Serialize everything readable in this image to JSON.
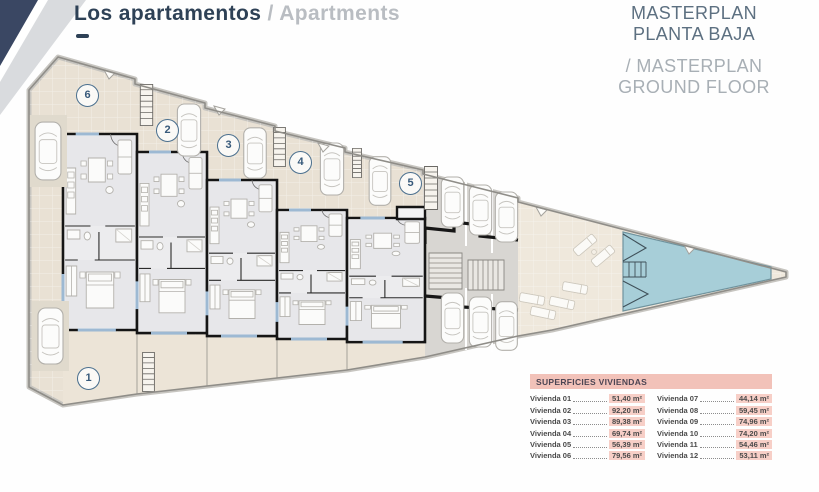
{
  "header": {
    "title_primary": "Los apartamentos",
    "title_secondary": "/ Apartments",
    "subtitle_primary_line1": "MASTERPLAN",
    "subtitle_primary_line2": "PLANTA BAJA",
    "subtitle_secondary_line1": "/ MASTERPLAN",
    "subtitle_secondary_line2": "GROUND FLOOR"
  },
  "plan": {
    "unit_markers": [
      {
        "number": "1"
      },
      {
        "number": "2"
      },
      {
        "number": "3"
      },
      {
        "number": "4"
      },
      {
        "number": "5"
      },
      {
        "number": "6"
      }
    ]
  },
  "surfaces_table": {
    "header": "SUPERFICIES VIVIENDAS",
    "rows_left": [
      {
        "label": "Vivienda 01",
        "value": "51,40 m²"
      },
      {
        "label": "Vivienda 02",
        "value": "92,20 m²"
      },
      {
        "label": "Vivienda 03",
        "value": "89,38 m²"
      },
      {
        "label": "Vivienda 04",
        "value": "69,74 m²"
      },
      {
        "label": "Vivienda 05",
        "value": "56,39 m²"
      },
      {
        "label": "Vivienda 06",
        "value": "79,56 m²"
      }
    ],
    "rows_right": [
      {
        "label": "Vivienda 07",
        "value": "44,14 m²"
      },
      {
        "label": "Vivienda 08",
        "value": "59,45 m²"
      },
      {
        "label": "Vivienda 09",
        "value": "74,96 m²"
      },
      {
        "label": "Vivienda 10",
        "value": "74,20 m²"
      },
      {
        "label": "Vivienda 11",
        "value": "54,46 m²"
      },
      {
        "label": "Vivienda 12",
        "value": "53,11 m²"
      }
    ]
  },
  "colors": {
    "accent_navy": "#2e4156",
    "title_gray": "#b9bdc2",
    "subtitle_blue_gray": "#5d7081",
    "subtitle_light_gray": "#a8afb5",
    "table_header_bg": "#f2c2b9",
    "table_chip_bg": "#f7cfc7",
    "pool_blue": "#a7ced8",
    "site_beige": "#e9e1d4",
    "courtyard_beige": "#efe8dc",
    "parking_gray": "#d8d6d2",
    "wall_black": "#1c1c1c",
    "window_blue": "#9db9d3",
    "marker_blue": "#4a6f8e"
  }
}
